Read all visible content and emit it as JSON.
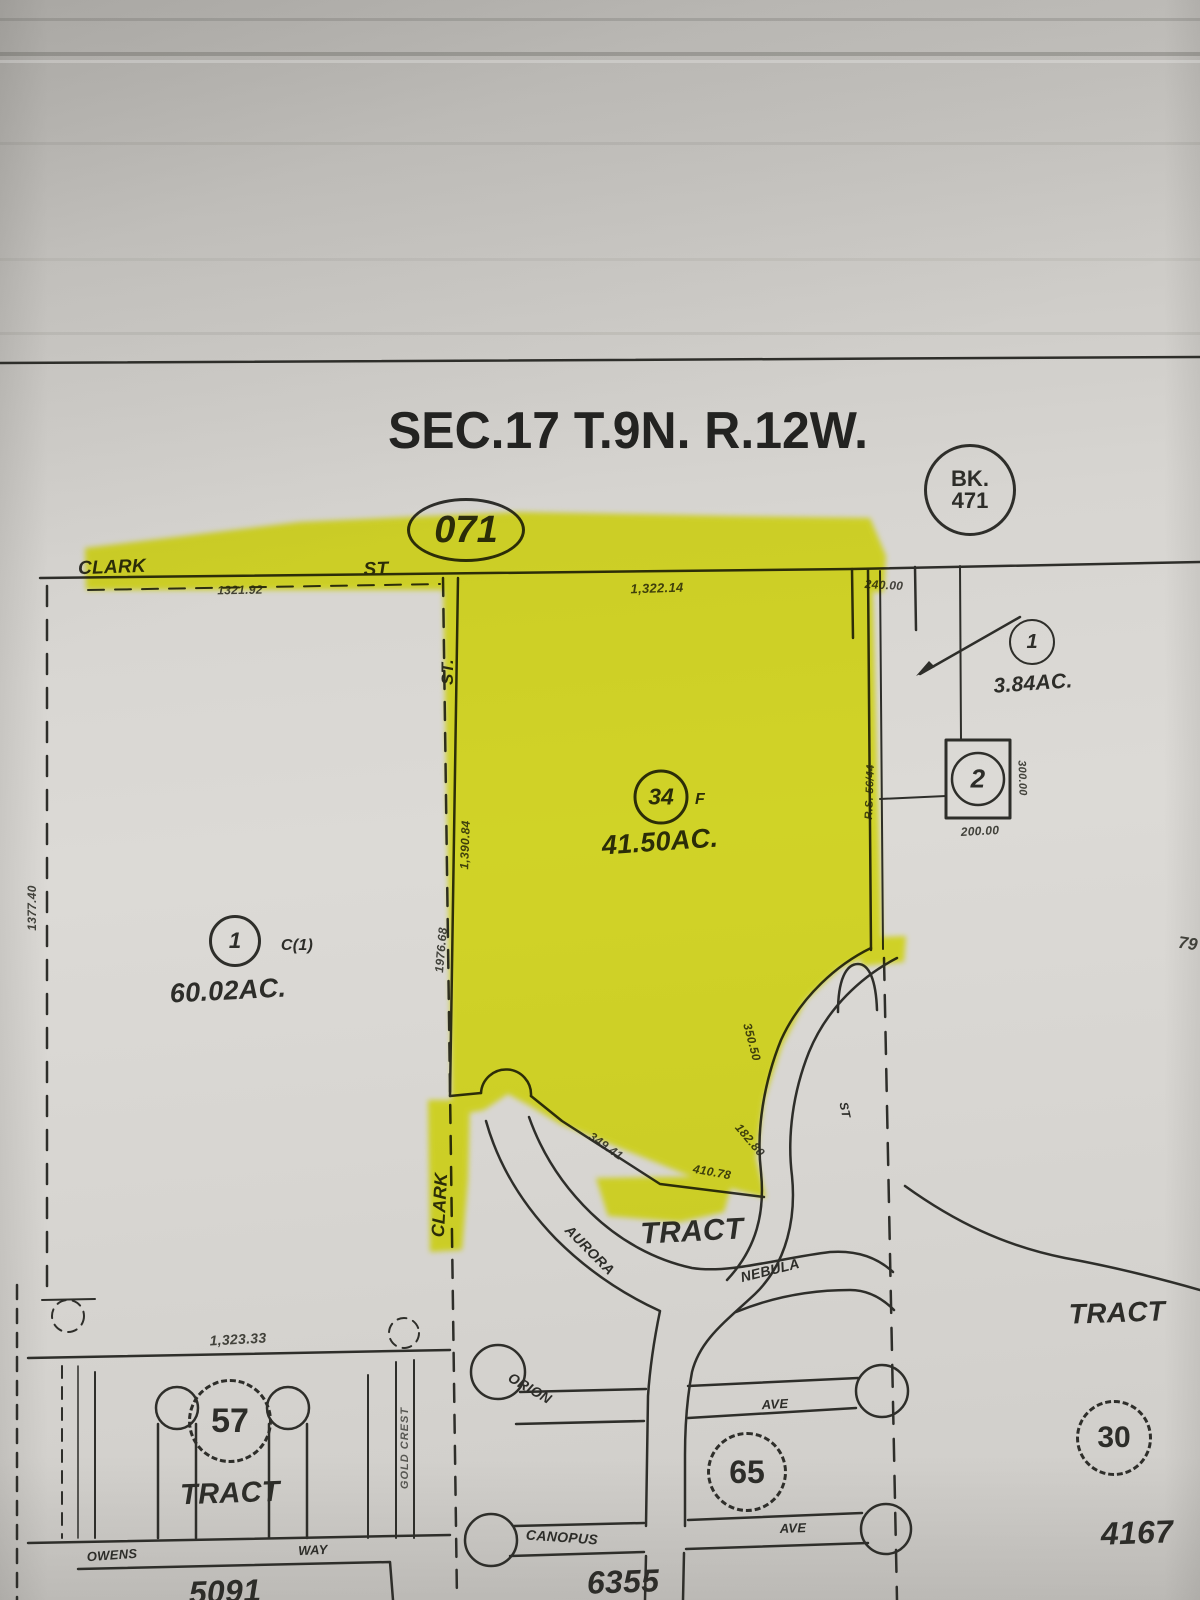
{
  "photo": {
    "highlighter_color": "#f0f600",
    "ink_color": "#2e2e2a",
    "paper_color": "#d8d6d2"
  },
  "header": {
    "section_title": "SEC.17 T.9N. R.12W.",
    "page_number": "071",
    "book_label": "BK.",
    "book_number": "471"
  },
  "parcels": {
    "left": {
      "number": "1",
      "code": "C(1)",
      "area": "60.02AC."
    },
    "center": {
      "number": "34",
      "suffix": "F",
      "area": "41.50AC."
    },
    "right": {
      "number": "1",
      "area": "3.84AC."
    },
    "square": {
      "number": "2"
    }
  },
  "tracts": {
    "label_center": "TRACT",
    "t57": {
      "number": "57",
      "label": "TRACT",
      "tract_no": "5091"
    },
    "t65": {
      "number": "65",
      "tract_no": "6355"
    },
    "t30": {
      "number": "30",
      "label": "TRACT",
      "tract_no": "4167"
    }
  },
  "streets": {
    "clark_top": "CLARK",
    "st_top": "ST",
    "st_vertical": "ST.",
    "clark_vertical": "CLARK",
    "nebula": "NEBULA",
    "aurora": "AURORA",
    "orion": "ORION",
    "canopus": "CANOPUS",
    "ave_upper": "AVE",
    "ave_lower": "AVE",
    "owens": "OWENS",
    "way": "WAY",
    "st_small": "ST",
    "gold_crest": "GOLD CREST"
  },
  "dimensions": {
    "top_left": "1321.92",
    "top_center": "1,322.14",
    "top_right": "240.00",
    "right_side": "300.00",
    "below_square": "200.00",
    "left_edge": "1377.40",
    "clark_upper": "1,390.84",
    "clark_lower": "1976.68",
    "east_note": "R.S. 56/44",
    "south_1": "349.41",
    "south_2": "410.78",
    "curve_1": "350.50",
    "curve_2": "182.80",
    "bottom_left": "1,323.33",
    "edge_partial": "79"
  }
}
